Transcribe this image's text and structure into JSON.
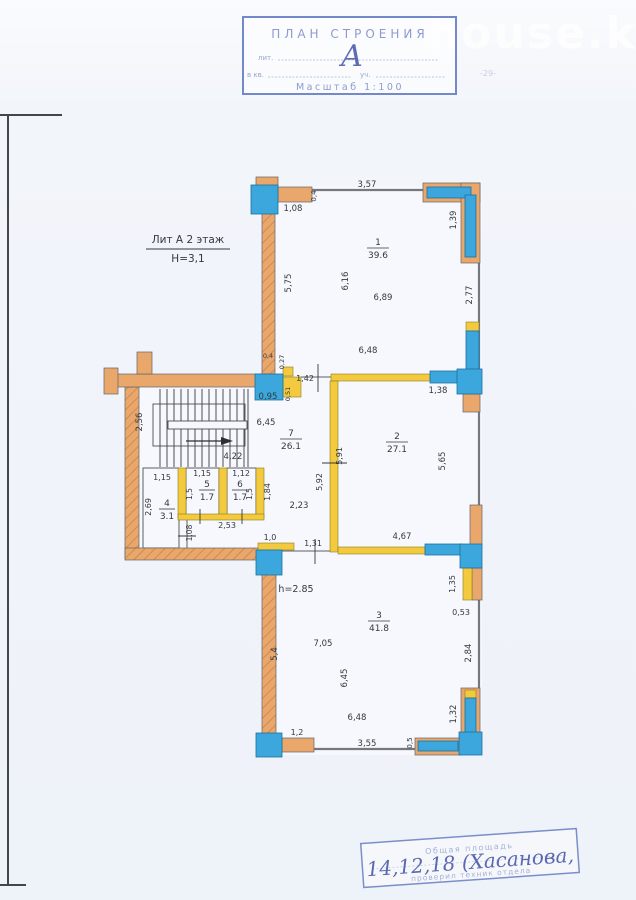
{
  "page": {
    "watermark": "house.kg",
    "page_mark": "-29-"
  },
  "title_stamp": {
    "title": "ПЛАН СТРОЕНИЯ",
    "lit_label": "лит.",
    "handwritten_letter": "А",
    "kv_label": "в кв.",
    "uch_label": "уч.",
    "scale": "Масштаб 1:100"
  },
  "floor_label": {
    "line1": "Лит А 2 этаж",
    "line2": "Н=3,1"
  },
  "room_labels": [
    {
      "num": "1",
      "area": "39.6",
      "x": 378,
      "y": 248
    },
    {
      "num": "2",
      "area": "27.1",
      "x": 397,
      "y": 442
    },
    {
      "num": "3",
      "area": "41.8",
      "x": 379,
      "y": 621
    },
    {
      "num": "7",
      "area": "26.1",
      "x": 291,
      "y": 439
    },
    {
      "num": "4",
      "area": "3.1",
      "x": 167,
      "y": 509
    },
    {
      "num": "5",
      "area": "1.7",
      "x": 207,
      "y": 490
    },
    {
      "num": "6",
      "area": "1.7",
      "x": 240,
      "y": 490
    }
  ],
  "dims": [
    {
      "t": "1,08",
      "x": 293,
      "y": 211,
      "r": 0
    },
    {
      "t": "0,4",
      "x": 316,
      "y": 196,
      "r": -90,
      "s": 7
    },
    {
      "t": "3,57",
      "x": 367,
      "y": 187,
      "r": 0
    },
    {
      "t": "1,39",
      "x": 456,
      "y": 220,
      "r": -90
    },
    {
      "t": "5,75",
      "x": 291,
      "y": 283,
      "r": -90
    },
    {
      "t": "6,16",
      "x": 348,
      "y": 281,
      "r": -90
    },
    {
      "t": "6,89",
      "x": 383,
      "y": 300,
      "r": 0
    },
    {
      "t": "2,77",
      "x": 472,
      "y": 295,
      "r": -90
    },
    {
      "t": "6,48",
      "x": 368,
      "y": 353,
      "r": 0
    },
    {
      "t": "0,4",
      "x": 268,
      "y": 358,
      "r": 0,
      "s": 6.5
    },
    {
      "t": "0,27",
      "x": 284,
      "y": 362,
      "r": -90,
      "s": 6.5
    },
    {
      "t": "1,42",
      "x": 305,
      "y": 381,
      "r": 0,
      "s": 8
    },
    {
      "t": "0,95",
      "x": 268,
      "y": 399,
      "r": 0
    },
    {
      "t": "0,51",
      "x": 290,
      "y": 394,
      "r": -90,
      "s": 6.5
    },
    {
      "t": "1,38",
      "x": 438,
      "y": 393,
      "r": 0
    },
    {
      "t": "6,45",
      "x": 266,
      "y": 425,
      "r": 0
    },
    {
      "t": "2,56",
      "x": 142,
      "y": 422,
      "r": -90
    },
    {
      "t": "4,22",
      "x": 233,
      "y": 459,
      "r": 0
    },
    {
      "t": "5,91",
      "x": 342,
      "y": 456,
      "r": -90,
      "s": 8
    },
    {
      "t": "5,92",
      "x": 322,
      "y": 482,
      "r": -90,
      "s": 8
    },
    {
      "t": "5,65",
      "x": 445,
      "y": 461,
      "r": -90
    },
    {
      "t": "4,67",
      "x": 402,
      "y": 539,
      "r": 0
    },
    {
      "t": "2,23",
      "x": 299,
      "y": 508,
      "r": 0
    },
    {
      "t": "1,15",
      "x": 162,
      "y": 480,
      "r": 0,
      "s": 8
    },
    {
      "t": "1,15",
      "x": 202,
      "y": 476,
      "r": 0,
      "s": 8
    },
    {
      "t": "1,12",
      "x": 241,
      "y": 476,
      "r": 0,
      "s": 8
    },
    {
      "t": "1,5",
      "x": 192,
      "y": 494,
      "r": -90,
      "s": 7.5
    },
    {
      "t": "1,5",
      "x": 252,
      "y": 494,
      "r": -90,
      "s": 7.5
    },
    {
      "t": "1,84",
      "x": 270,
      "y": 492,
      "r": -90,
      "s": 8
    },
    {
      "t": "2,69",
      "x": 151,
      "y": 507,
      "r": -90,
      "s": 8
    },
    {
      "t": "1,08",
      "x": 192,
      "y": 533,
      "r": -90,
      "s": 7.5
    },
    {
      "t": "2,53",
      "x": 227,
      "y": 528,
      "r": 0,
      "s": 8
    },
    {
      "t": "1,0",
      "x": 270,
      "y": 540,
      "r": 0,
      "s": 8
    },
    {
      "t": "1,31",
      "x": 313,
      "y": 546,
      "r": 0,
      "s": 8
    },
    {
      "t": "h=2.85",
      "x": 296,
      "y": 592,
      "r": 0,
      "s": 9.5
    },
    {
      "t": "7,05",
      "x": 323,
      "y": 646,
      "r": 0
    },
    {
      "t": "5,4",
      "x": 277,
      "y": 654,
      "r": -90
    },
    {
      "t": "6,45",
      "x": 347,
      "y": 678,
      "r": -90
    },
    {
      "t": "6,48",
      "x": 357,
      "y": 720,
      "r": 0
    },
    {
      "t": "1,2",
      "x": 297,
      "y": 735,
      "r": 0,
      "s": 8
    },
    {
      "t": "3,55",
      "x": 367,
      "y": 746,
      "r": 0
    },
    {
      "t": "0,5",
      "x": 412,
      "y": 743,
      "r": -90,
      "s": 7
    },
    {
      "t": "1,32",
      "x": 456,
      "y": 714,
      "r": -90
    },
    {
      "t": "1,35",
      "x": 455,
      "y": 584,
      "r": -90,
      "s": 8
    },
    {
      "t": "0,53",
      "x": 461,
      "y": 615,
      "r": 0,
      "s": 8
    },
    {
      "t": "2,84",
      "x": 471,
      "y": 653,
      "r": -90
    }
  ],
  "bottom_stamp": {
    "line1": "Общая площадь",
    "line2": "проверил техник отдела",
    "handwritten": "14,12,18 (Хасанова,"
  },
  "colors": {
    "exterior_wall": "#eaa76c",
    "wall_hatch": "#d08b4e",
    "partition": "#f3c93d",
    "window": "#3ba7dc",
    "thin_wall": "#75797f",
    "dim_text": "#35383f",
    "stamp_blue": "#8b9bd2",
    "handwriting_blue": "#4a59a8"
  }
}
